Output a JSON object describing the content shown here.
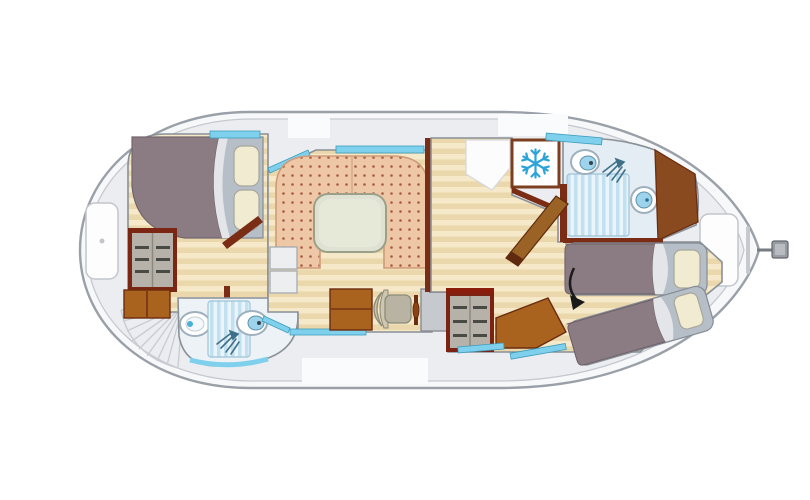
{
  "diagram": {
    "type": "boat-floorplan-top-view",
    "vessel": "canal cruiser hull with rounded bow (left), pointed stern with rudder (right)"
  },
  "colors": {
    "hull-fill": "#f7f8fa",
    "hull-line": "#9aa0a8",
    "hull-line2": "#c5c9cf",
    "deck": "#ebedf0",
    "wall": "#8a9097",
    "maroon": "#7b2c14",
    "wood-a": "#f5e9c9",
    "wood-b": "#ead7ac",
    "brown": "#a9631f",
    "brown-dark": "#6b2c10",
    "brown-mid": "#9a6224",
    "uph": "#eec7a6",
    "uph-dot": "#a85a42",
    "uph-line": "#cf9b78",
    "table": "#dfe2d2",
    "table-line": "#9ba189",
    "blanket": "#8b7b82",
    "blanket-dark": "#6e6067",
    "bedbase": "#b6bec8",
    "pillow": "#f1ecd1",
    "sheet": "#e3e5e9",
    "window": "#7fd0ec",
    "window-dark": "#3e9dbd",
    "bath": "#edf2f6",
    "ring": "#9fb0bc",
    "water": "#8fc8e2",
    "water-dark": "#2ea3d8",
    "mat-a": "#c2e0f0",
    "mat-b": "#e9f5fb",
    "mat-line": "#9cc3d8",
    "steel": "#c6c9cd",
    "chair-seat": "#b9b3a3",
    "chair-back": "#cfc6ae"
  },
  "rooms": [
    {
      "name": "forward-cabin",
      "furniture": [
        "double-bed",
        "two-pillows",
        "wardrobe-shelves",
        "storage-cabinet",
        "open-door"
      ]
    },
    {
      "name": "forward-bathroom",
      "furniture": [
        "round-sink",
        "shower-mat",
        "toilet"
      ]
    },
    {
      "name": "saloon",
      "furniture": [
        "u-shaped-dinette",
        "oval-table",
        "companionway-steps"
      ]
    },
    {
      "name": "helm-station",
      "furniture": [
        "bench",
        "swivel-chair",
        "steering-wheel",
        "instrument-console",
        "wardrobe-shelves"
      ]
    },
    {
      "name": "galley",
      "furniture": [
        "drainer",
        "sink",
        "two-burner-stove",
        "counter",
        "freezer-box"
      ]
    },
    {
      "name": "aft-bathroom",
      "furniture": [
        "toilet",
        "shower-mat",
        "round-sink",
        "cabinet"
      ]
    },
    {
      "name": "aft-cabin",
      "furniture": [
        "single-bed-upper",
        "single-bed-angled",
        "conversion-arrow"
      ]
    }
  ],
  "icons": [
    "snowflake-icon",
    "shower-head-icon",
    "toilet-icon",
    "sink-icon",
    "stove-burner-icon",
    "steering-wheel-icon",
    "stairs-icon",
    "rudder-icon",
    "arrow-icon"
  ],
  "decks": [
    "bow-locker-hatch",
    "stern-locker-hatch",
    "side-walkways",
    "bow-steps"
  ]
}
